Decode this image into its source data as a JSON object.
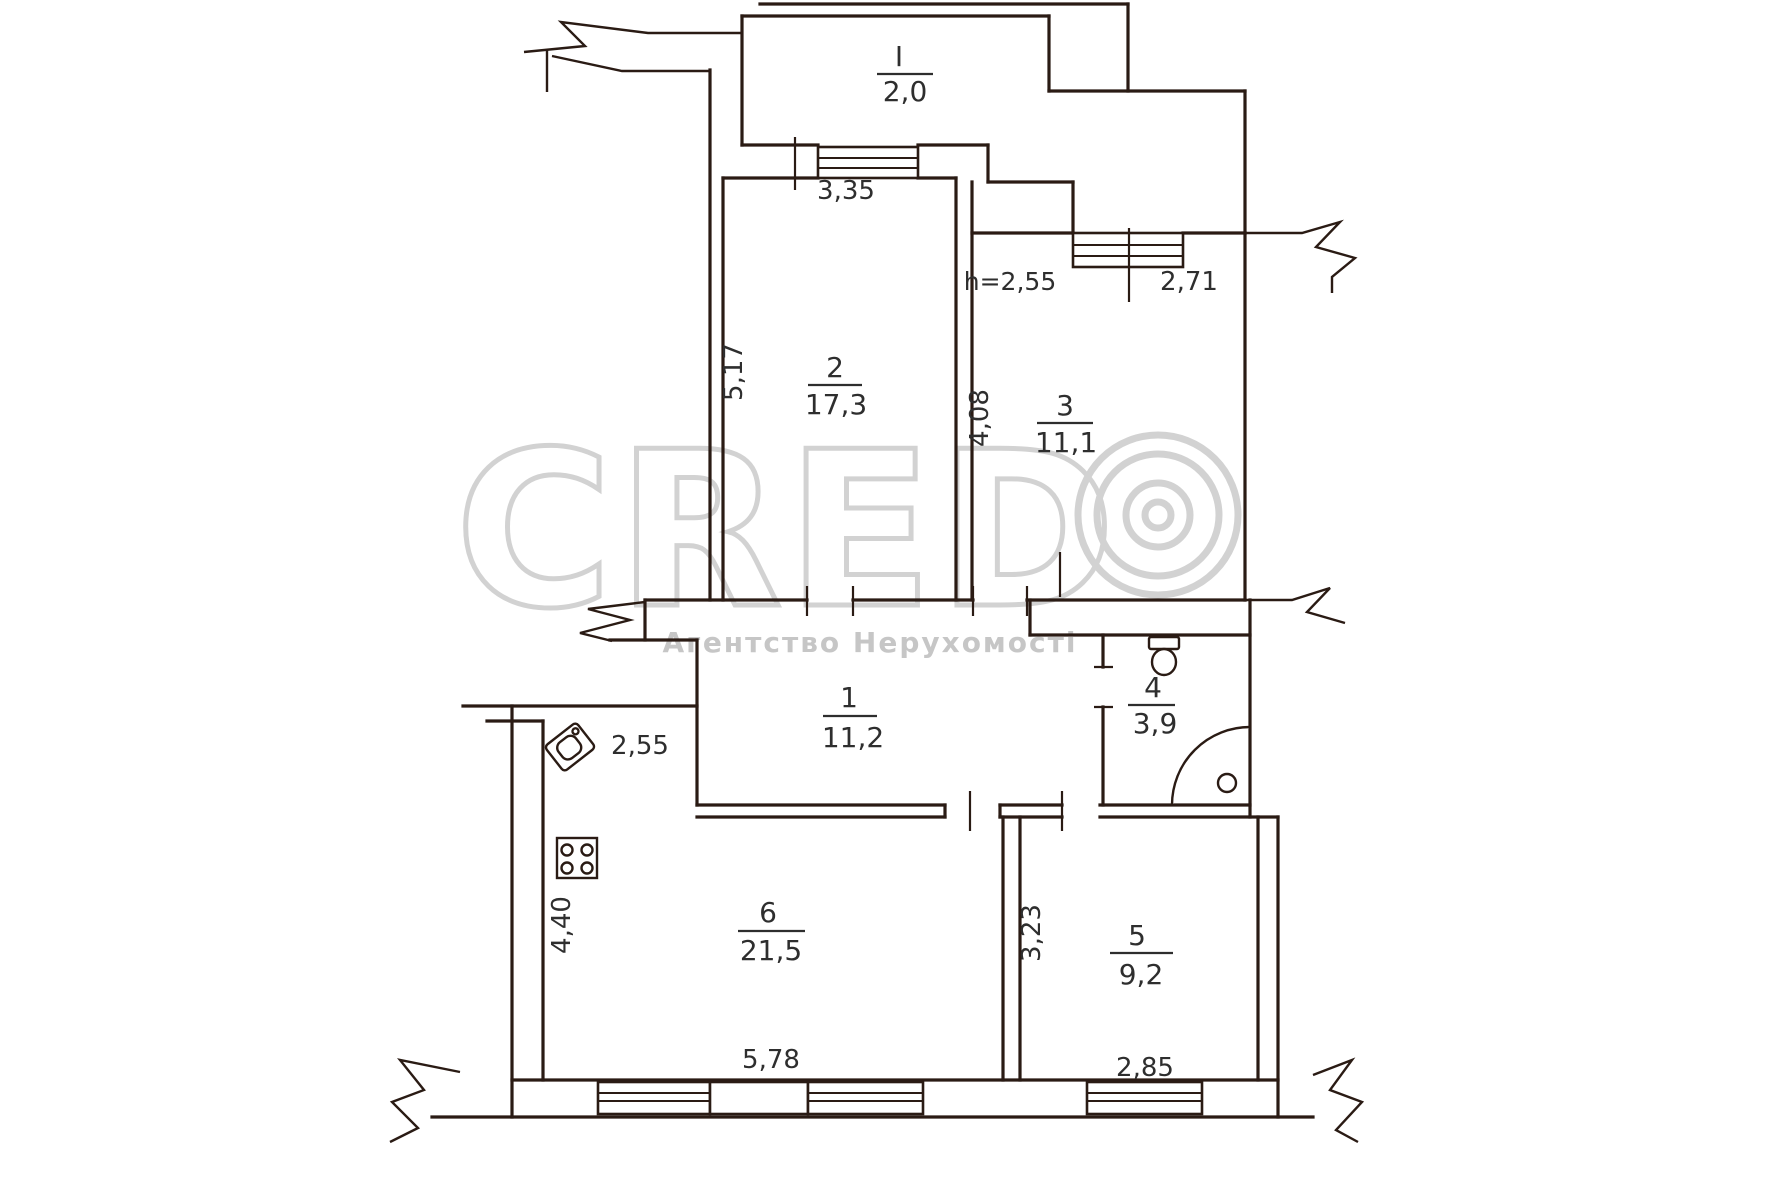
{
  "title": "Apartment floor plan",
  "watermark": {
    "brand": "CRED",
    "logo_mark": "copyright-rings",
    "subtitle": "Агентство Нерухомості",
    "color": "#d2d2d2"
  },
  "rooms": [
    {
      "id": "balcony",
      "number": "I",
      "area": "2,0"
    },
    {
      "id": "hallway",
      "number": "1",
      "area": "11,2"
    },
    {
      "id": "room2",
      "number": "2",
      "area": "17,3"
    },
    {
      "id": "room3",
      "number": "3",
      "area": "11,1"
    },
    {
      "id": "bathroom",
      "number": "4",
      "area": "3,9"
    },
    {
      "id": "room5",
      "number": "5",
      "area": "9,2"
    },
    {
      "id": "kitchen",
      "number": "6",
      "area": "21,5"
    }
  ],
  "dimensions": {
    "balcony_window": "3,35",
    "ceiling_height": "h=2,55",
    "room3_window": "2,71",
    "room2_depth": "5,17",
    "room3_depth": "4,08",
    "kitchen_top": "2,55",
    "kitchen_depth": "4,40",
    "kitchen_width": "5,78",
    "room5_depth": "3,23",
    "room5_width": "2,85"
  },
  "fixtures": [
    "toilet",
    "shower",
    "kitchen-sink",
    "stove"
  ],
  "colors": {
    "walls": "#2a1b14",
    "text": "#2e2e2e",
    "watermark": "#d2d2d2",
    "background": "#ffffff"
  }
}
